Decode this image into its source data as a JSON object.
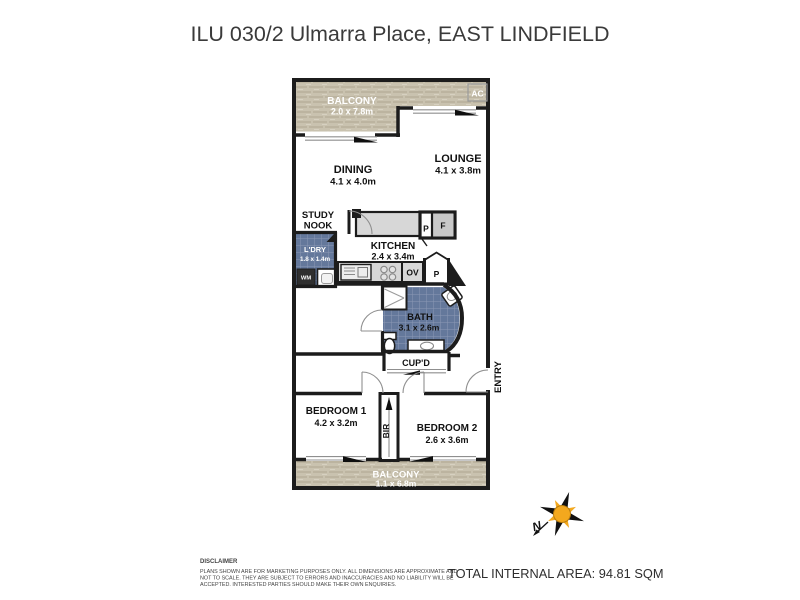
{
  "title": "ILU 030/2 Ulmarra Place, EAST LINDFIELD",
  "plan": {
    "balcony_top": {
      "label": "BALCONY",
      "dims": "2.0 x 7.8m"
    },
    "ac_label": "AC",
    "dining": {
      "label": "DINING",
      "dims": "4.1 x 4.0m"
    },
    "lounge": {
      "label": "LOUNGE",
      "dims": "4.1 x 3.8m"
    },
    "study_nook": {
      "line1": "STUDY",
      "line2": "NOOK"
    },
    "laundry": {
      "label": "L'DRY",
      "dims": "1.8 x 1.4m"
    },
    "wm_label": "WM",
    "kitchen": {
      "label": "KITCHEN",
      "dims": "2.4 x 3.4m"
    },
    "pantry_upper_label": "P",
    "fridge_label": "F",
    "oven_label": "OV",
    "pantry_lower_label": "P",
    "bath": {
      "label": "BATH",
      "dims": "3.1 x 2.6m"
    },
    "cupboard_label": "CUP'D",
    "entry_label": "ENTRY",
    "bedroom1": {
      "label": "BEDROOM 1",
      "dims": "4.2 x 3.2m"
    },
    "bir_label": "BIR",
    "bedroom2": {
      "label": "BEDROOM 2",
      "dims": "2.6 x 3.6m"
    },
    "balcony_bottom": {
      "label": "BALCONY",
      "dims": "1.1 x 6.8m"
    },
    "compass_north_label": "N"
  },
  "footer": {
    "disclaimer_heading": "DISCLAIMER",
    "disclaimer_line1": "PLANS SHOWN ARE FOR MARKETING PURPOSES ONLY. ALL DIMENSIONS ARE APPROXIMATE AND",
    "disclaimer_line2": "NOT TO SCALE. THEY ARE SUBJECT TO ERRORS AND INACCURACIES AND NO LIABILITY WILL BE",
    "disclaimer_line3": "ACCEPTED. INTERESTED PARTIES SHOULD MAKE THEIR OWN ENQUIRIES.",
    "total_area": "TOTAL INTERNAL AREA: 94.81 SQM"
  },
  "colors": {
    "wall": "#1c1c1c",
    "balcony_fill": "#c9c2af",
    "tile_fill": "#64789b",
    "tile_grid": "#8b99b5",
    "bench_fill": "#d7d7d7",
    "fridge_fill": "#c9c9c9",
    "compass_orange": "#f3a81e",
    "title_text": "#3a3a3a"
  }
}
